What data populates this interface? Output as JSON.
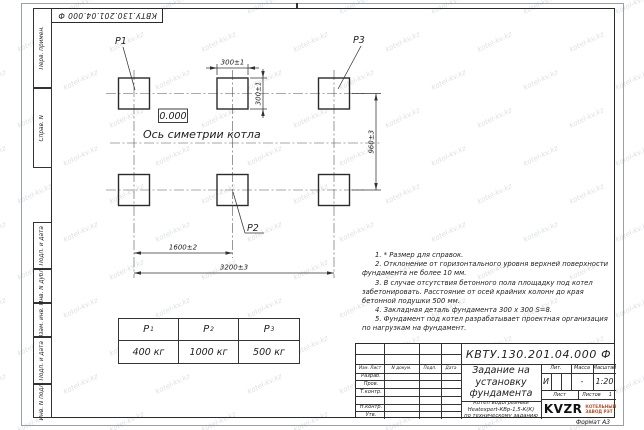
{
  "watermark": {
    "text": "kotel-kv.kz"
  },
  "frame": {
    "top_stamp": "КВТУ.130.201.04.000 Ф",
    "margin_labels": [
      "Перв. примен.",
      "Справ. N",
      "Подп. и дата",
      "Инв. N дубл.",
      "Взам. инв. N",
      "Подп. и дата",
      "Инв. N подл."
    ],
    "format_label": "Формат А3"
  },
  "drawing": {
    "anchor_labels": {
      "p1": "P1",
      "p2": "P2",
      "p3": "P3"
    },
    "elevation_mark": "0.000",
    "axis_caption": "Ось симетрии котла",
    "dimensions": {
      "pad_width": "300±1",
      "pad_height": "300±1",
      "row_spacing": "960±3",
      "col_spacing": "1600±2",
      "overall": "3200±3"
    }
  },
  "loads_table": {
    "headers": [
      {
        "base": "P",
        "sub": "1"
      },
      {
        "base": "P",
        "sub": "2"
      },
      {
        "base": "P",
        "sub": "3"
      }
    ],
    "values": [
      "400 кг",
      "1000 кг",
      "500 кг"
    ]
  },
  "notes": [
    "1. * Размер для справок.",
    "2. Отклонение от горизонтального уровня верхней поверхности фундамента не более 10 мм.",
    "3. В случае отсутствия бетонного пола площадку под котел забетонировать. Расстояние от осей крайних колонн до края бетонной подушки 500 мм.",
    "4. Закладная деталь фундамента 300 x 300 S=8.",
    "5. Фундамент под котел разрабатывает проектная организация по нагрузкам на фундамент."
  ],
  "title_block": {
    "doc_number": "КВТУ.130.201.04.000  Ф",
    "title": "Задание на установку фундамента",
    "subtitle": [
      "Котел водогрейный",
      "Heatexpert-КВр-1,5-К(К)",
      "по техническому заданию"
    ],
    "header_cols": [
      "Изм. Лист",
      "N докум.",
      "Подп.",
      "Дата"
    ],
    "sign_rows": [
      "Разраб.",
      "Пров.",
      "Т.контр.",
      "",
      "Н.контр.",
      "Утв."
    ],
    "lit_label": "Лит.",
    "lit_value": "И",
    "mass_label": "Масса",
    "mass_value": "-",
    "scale_label": "Масштаб",
    "scale_value": "1:20",
    "sheet_label": "Лист",
    "sheets_label": "Листов",
    "sheets_value": "1",
    "logo_text": "KVZR",
    "company": [
      "КОТЕЛЬНЫЙ",
      "ЗАВОД РЭТ"
    ]
  }
}
